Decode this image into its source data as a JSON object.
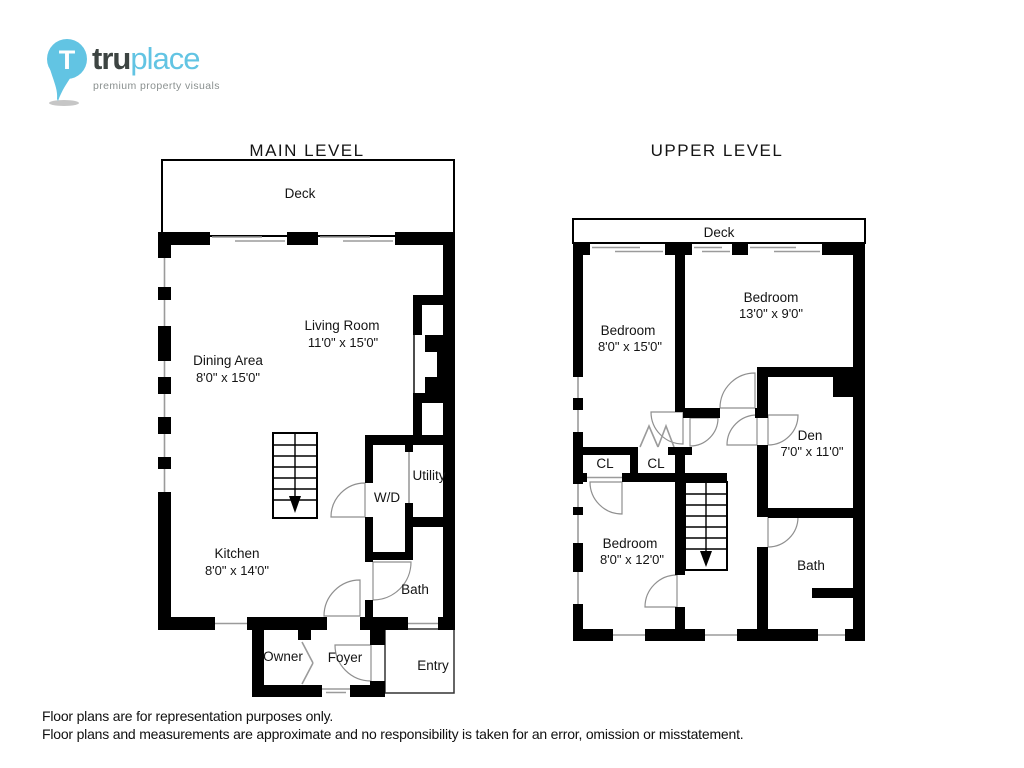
{
  "brand": {
    "name_bold": "tru",
    "name_light": "place",
    "tagline": "premium property visuals",
    "pin_letter": "T",
    "accent_color": "#62c4e3",
    "dark_color": "#3d4442",
    "wall_color": "#000000"
  },
  "main_level": {
    "title": "MAIN LEVEL",
    "deck": "Deck",
    "rooms": {
      "living": {
        "name": "Living Room",
        "dims": "11'0\" x 15'0\""
      },
      "dining": {
        "name": "Dining Area",
        "dims": "8'0\" x 15'0\""
      },
      "kitchen": {
        "name": "Kitchen",
        "dims": "8'0\" x 14'0\""
      },
      "wd": {
        "name": "W/D"
      },
      "utility": {
        "name": "Utility"
      },
      "bath": {
        "name": "Bath"
      },
      "owner": {
        "name": "Owner"
      },
      "foyer": {
        "name": "Foyer"
      },
      "entry": {
        "name": "Entry"
      }
    }
  },
  "upper_level": {
    "title": "UPPER LEVEL",
    "deck": "Deck",
    "rooms": {
      "bedroom_left": {
        "name": "Bedroom",
        "dims": "8'0\" x 15'0\""
      },
      "bedroom_top": {
        "name": "Bedroom",
        "dims": "13'0\" x 9'0\""
      },
      "den": {
        "name": "Den",
        "dims": "7'0\" x 11'0\""
      },
      "cl1": {
        "name": "CL"
      },
      "cl2": {
        "name": "CL"
      },
      "bedroom_lower": {
        "name": "Bedroom",
        "dims": "8'0\" x 12'0\""
      },
      "bath": {
        "name": "Bath"
      }
    }
  },
  "footer": {
    "line1": "Floor plans are for representation purposes only.",
    "line2": "Floor plans and measurements are approximate and no responsibility is taken for an error, omission or misstatement."
  }
}
